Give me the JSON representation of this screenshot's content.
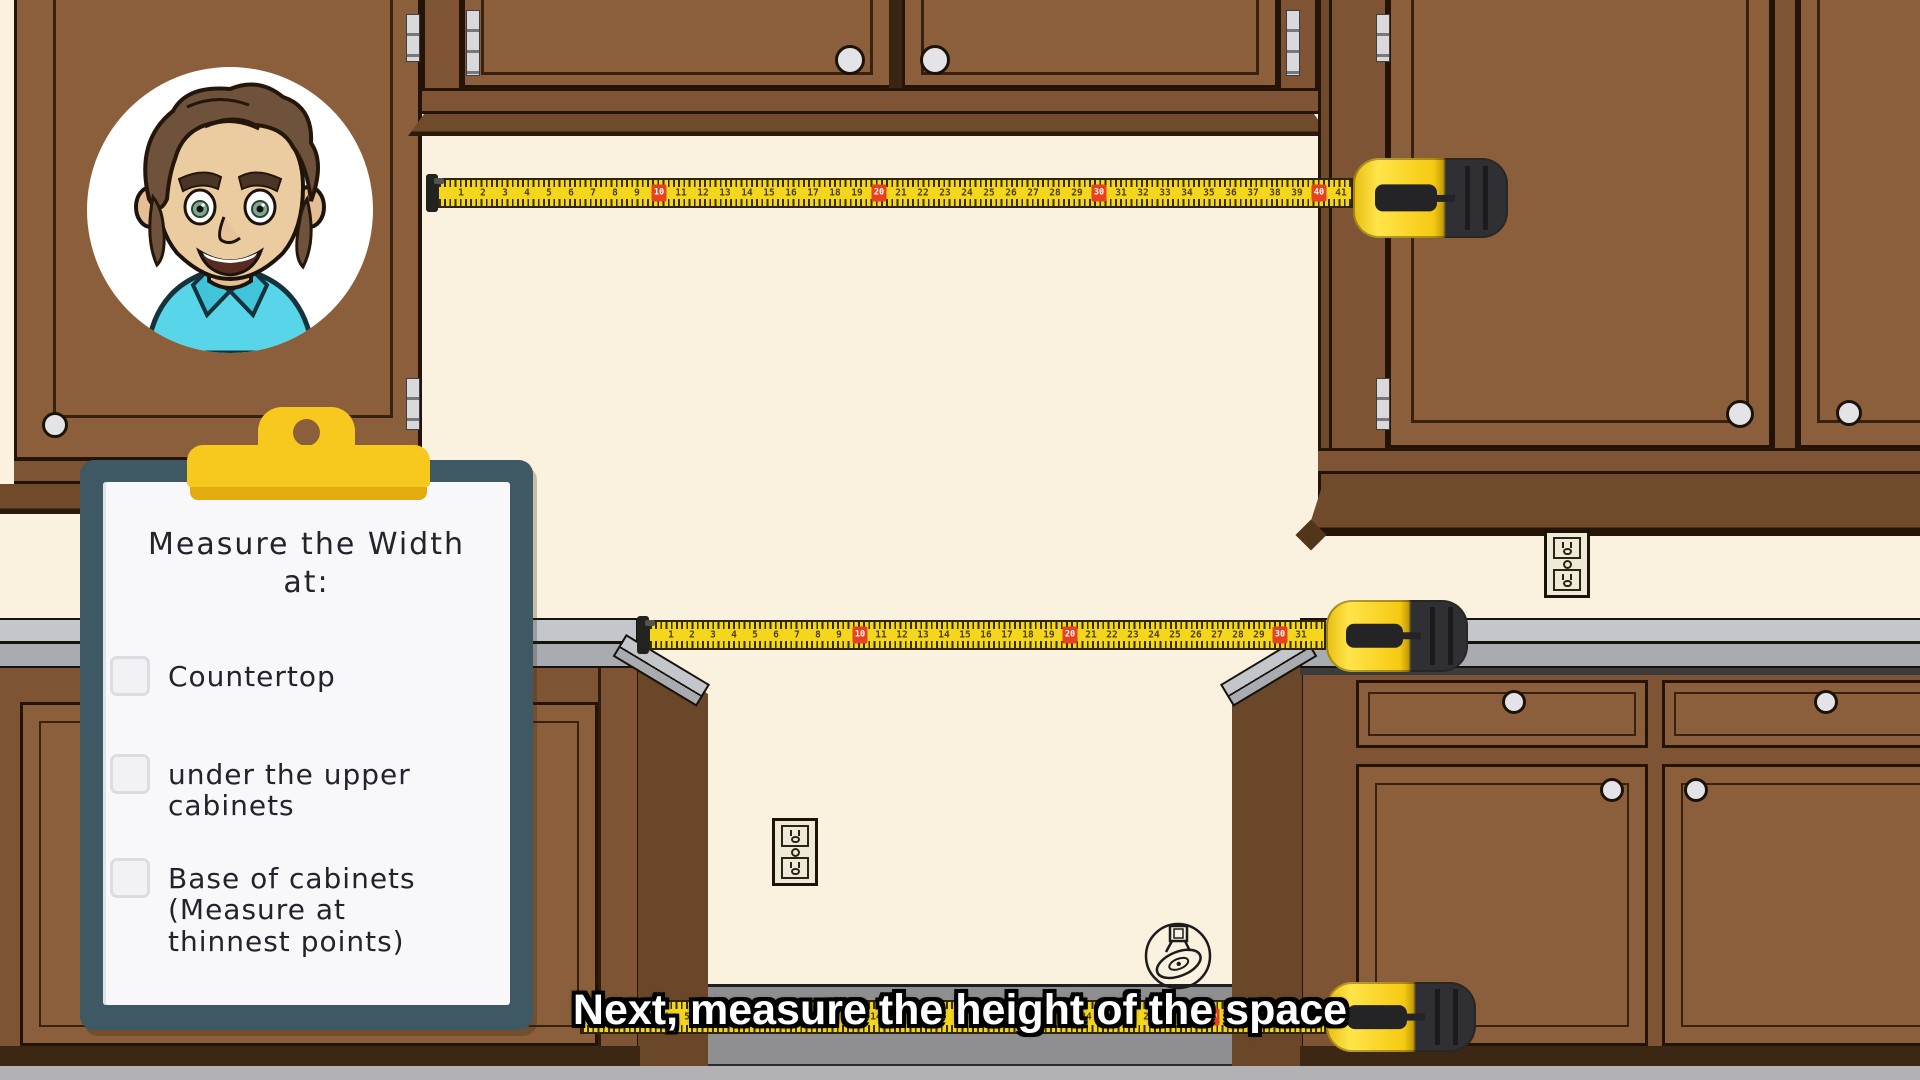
{
  "caption": {
    "text": "Next, measure the height of the space"
  },
  "clipboard": {
    "title": "Measure the Width",
    "title_suffix": "at:",
    "items": [
      {
        "label": "Countertop",
        "checked": false
      },
      {
        "label": "under the upper cabinets",
        "checked": false
      },
      {
        "label": "Base of cabinets (Measure at thinnest points)",
        "checked": false
      }
    ]
  },
  "tapes": [
    {
      "name": "upper-opening-width-tape",
      "units": 41,
      "red_every": 10
    },
    {
      "name": "countertop-width-tape",
      "units": 31,
      "red_every": 10
    },
    {
      "name": "base-width-tape",
      "units": 34,
      "red_every": 10
    }
  ],
  "colors": {
    "wall_cream": "#FAF1DF",
    "cabinet_brown": "#8B5F3B",
    "cabinet_frame": "#7E5434",
    "trim_dark": "#6F4A2B",
    "counter_gray": "#C3C7CC",
    "floor_gray": "#B2B2B4",
    "tape_yellow": "#F4D61C",
    "tape_red": "#E8411F",
    "clipboard_teal": "#3E5864",
    "clip_yellow": "#F7C91E",
    "caption_text": "#FFFFFF",
    "shirt_cyan": "#58D5E8"
  }
}
